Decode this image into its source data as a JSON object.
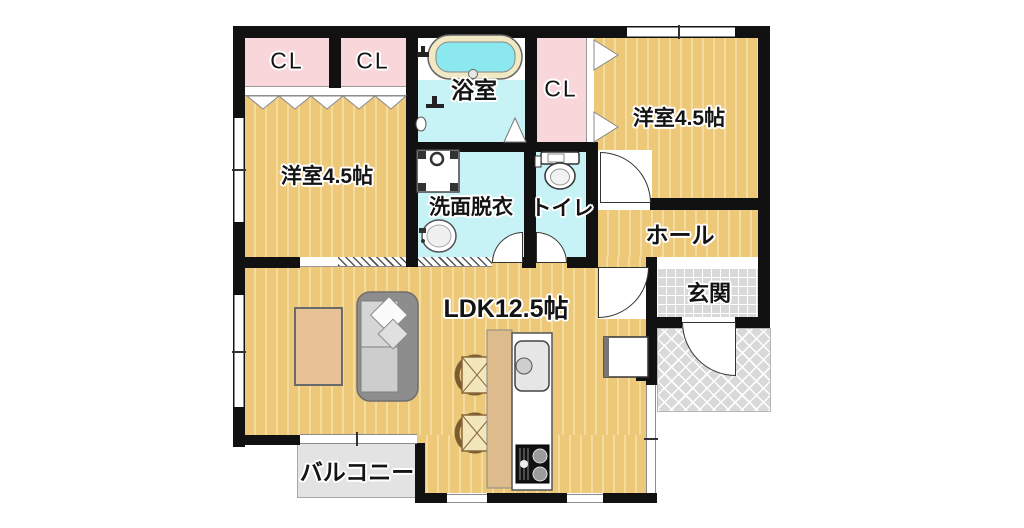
{
  "type": "japanese-apartment-floor-plan",
  "rooms": {
    "closet1": "CL",
    "closet2": "CL",
    "closet3": "CL",
    "bathroom": "浴室",
    "bedroom_left": "洋室4.5帖",
    "bedroom_right": "洋室4.5帖",
    "washroom": "洗面脱衣",
    "toilet": "トイレ",
    "hall": "ホール",
    "entrance": "玄関",
    "ldk": "LDK12.5帖",
    "balcony": "バルコニー"
  },
  "fixtures": [
    "bathtub",
    "bath-faucet",
    "shower-faucet",
    "bath-folding-door",
    "washing-machine-pan",
    "vanity-sink",
    "toilet-bowl",
    "bifold-closet-doors-left",
    "bifold-closet-doors-right",
    "sliding-door-hatch",
    "hinged-door-arcs",
    "low-table",
    "sofa",
    "cushion-pillows",
    "dining-chairs",
    "kitchen-counter",
    "kitchen-sink",
    "gas-stove",
    "cabinet"
  ],
  "colors": {
    "wall": "#111111",
    "wood-base": "#ecc878",
    "wood-stripe": "#f4db9e",
    "closet-pink": "#f9d6da",
    "wet-cyan": "#c7f2f6",
    "tub-water": "#8ce8ef",
    "tub-rim": "#f1e9c4",
    "entrance-gray": "#d9d9d9",
    "balcony-gray": "#e3e3e3",
    "counter-tan": "#debb8d",
    "sofa-gray": "#8d8d8d",
    "table-tan": "#e7c296"
  }
}
